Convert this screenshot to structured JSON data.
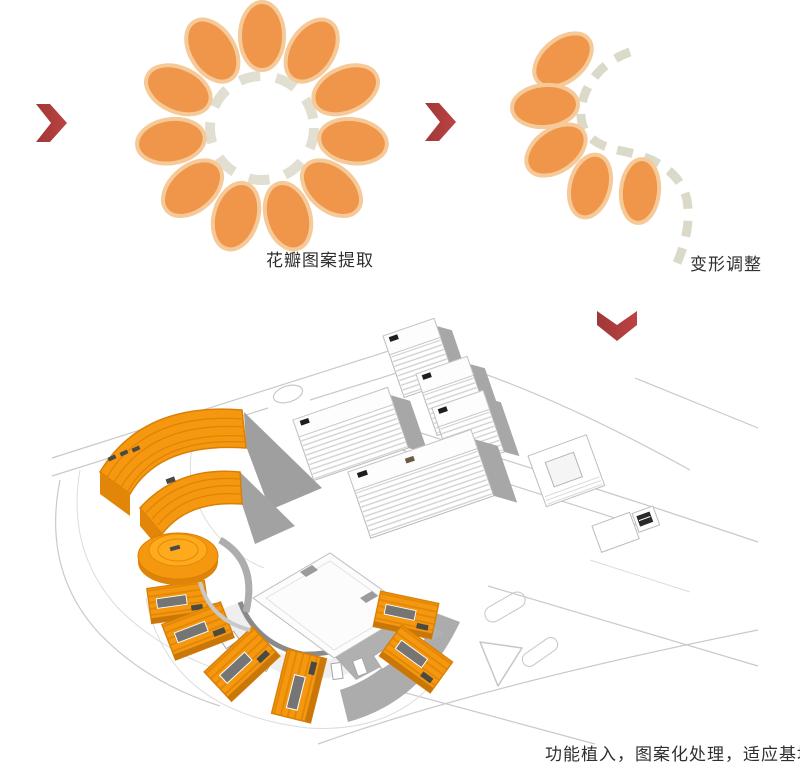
{
  "figure": {
    "captions": {
      "extract": "花瓣图案提取",
      "deform": "变形调整",
      "implant": "功能植入，图案化处理，适应基地"
    },
    "flower": {
      "petal_count": 11,
      "petal_color": "#F0964B",
      "petal_outline": "#F6C998",
      "dash_color": "#E0DFD2"
    },
    "deformed_flower": {
      "petal_count": 5,
      "curve": "dashed S-curve"
    },
    "arrows": {
      "color": "#B83E3E",
      "right_arrow_count": 2,
      "down_arrow_count": 1
    },
    "site_model": {
      "orange": "#F6960F",
      "orange_dark": "#DF8406",
      "shadow_gray": "#A7A7A7",
      "road_gray": "#C9C9C9",
      "orange_petal_buildings": 6,
      "orange_fan_buildings": 2,
      "round_building": 1,
      "white_towers": 5
    }
  }
}
